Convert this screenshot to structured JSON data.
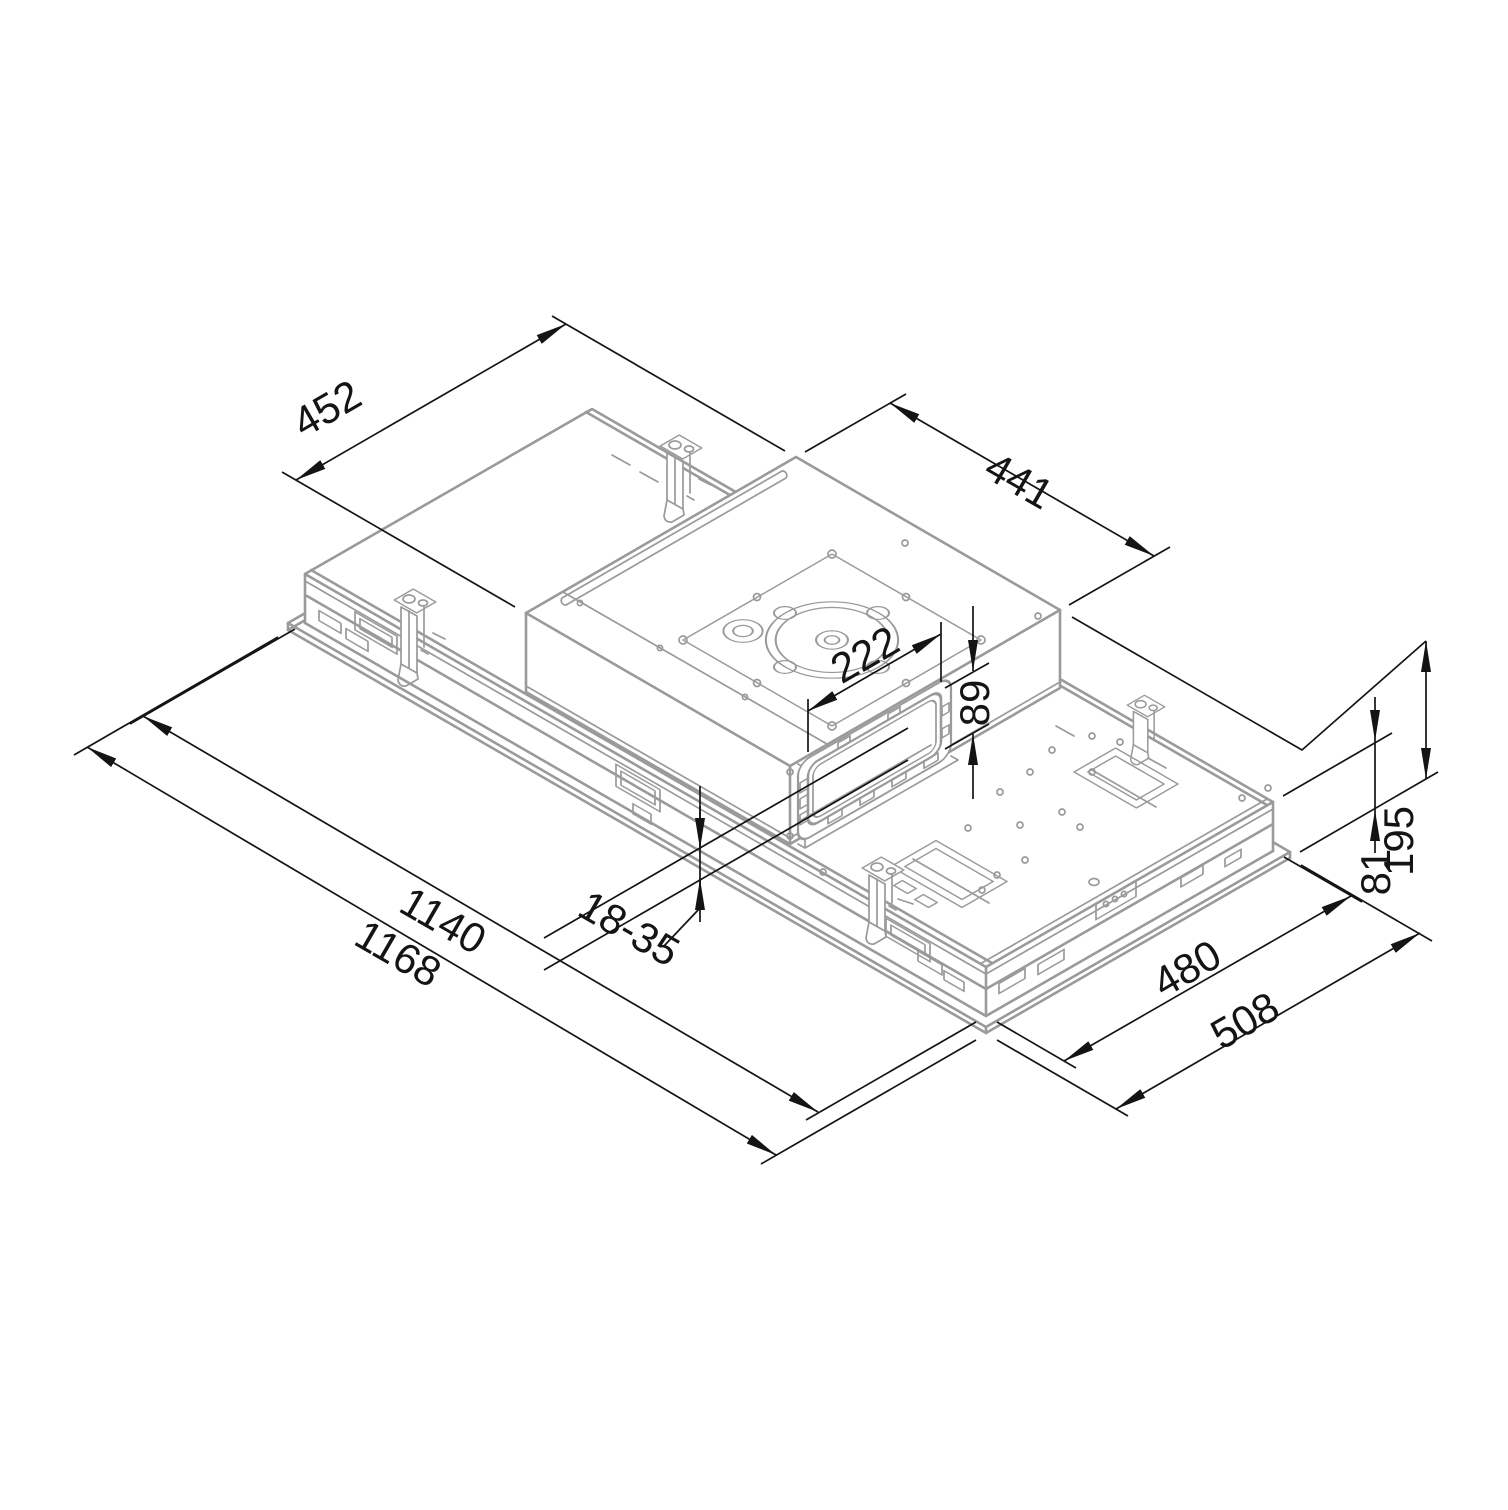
{
  "drawing_type": "isometric-dimension-drawing",
  "subject": "ceiling-built-in-extractor-unit",
  "colors": {
    "part_line": "#9a9a9a",
    "dim_line": "#141414",
    "label_color": "#141414",
    "bg": "#ffffff"
  },
  "dimensions": {
    "canopy_depth": "452",
    "canopy_length": "441",
    "duct_outlet_width": "222",
    "duct_outlet_height": "89",
    "ceiling_panel_clamp_range": "18-35",
    "recess_length": "1140",
    "overall_length": "1168",
    "recess_depth": "480",
    "overall_depth": "508",
    "body_height": "81",
    "overall_height": "195"
  }
}
